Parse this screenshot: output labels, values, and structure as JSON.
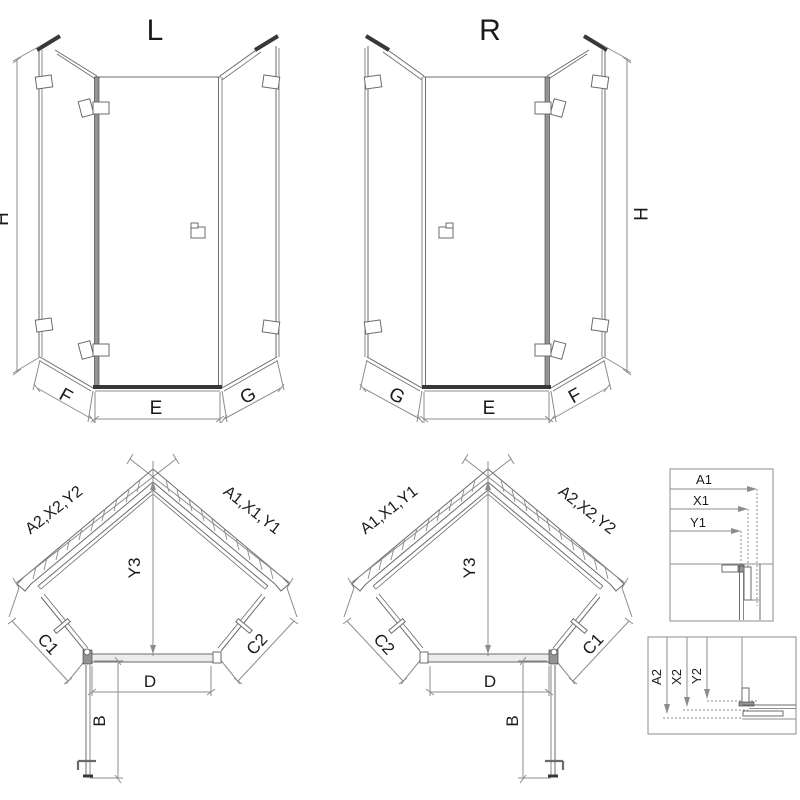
{
  "views": {
    "elevation_left": {
      "label": "L",
      "dim_height": "H",
      "dim_bottom_left": "F",
      "dim_bottom_center": "E",
      "dim_bottom_right": "G"
    },
    "elevation_right": {
      "label": "R",
      "dim_height": "H",
      "dim_bottom_left": "G",
      "dim_bottom_center": "E",
      "dim_bottom_right": "F"
    },
    "plan_left": {
      "dim_wall_left": "A2,X2,Y2",
      "dim_wall_right": "A1,X1,Y1",
      "dim_depth": "Y3",
      "dim_side_left": "C1",
      "dim_side_right": "C2",
      "dim_front": "D",
      "dim_door": "B"
    },
    "plan_right": {
      "dim_wall_left": "A1,X1,Y1",
      "dim_wall_right": "A2,X2,Y2",
      "dim_depth": "Y3",
      "dim_side_left": "C2",
      "dim_side_right": "C1",
      "dim_front": "D",
      "dim_door": "B"
    },
    "detail_top": {
      "dim_1": "A1",
      "dim_2": "X1",
      "dim_3": "Y1"
    },
    "detail_bottom": {
      "dim_1": "A2",
      "dim_2": "X2",
      "dim_3": "Y2"
    }
  },
  "colors": {
    "bg": "#ffffff",
    "line": "#6b6b6b",
    "dim": "#8c8c8c",
    "dark": "#383838",
    "profile": "#949494",
    "tray": "#ececec",
    "text": "#1a1a1a"
  }
}
